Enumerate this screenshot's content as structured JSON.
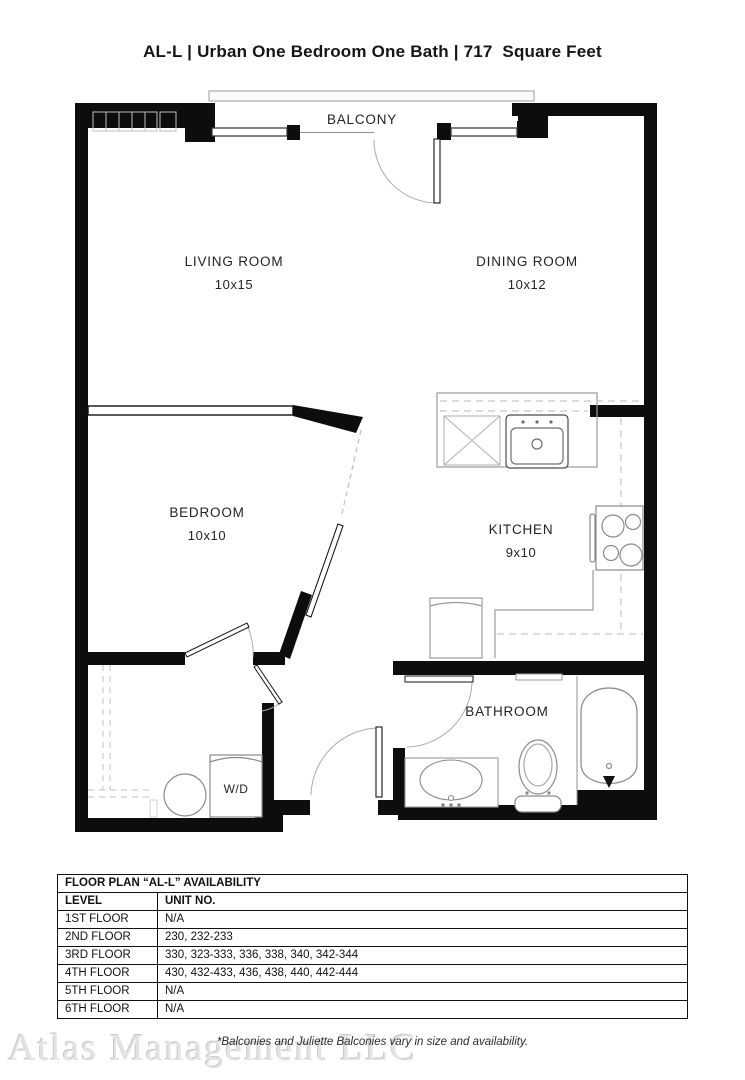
{
  "title": "AL-L | Urban One Bedroom One Bath | 717  Square Feet",
  "floor_plan": {
    "balcony_label": "BALCONY",
    "rooms": {
      "living": {
        "name": "LIVING ROOM",
        "dims": "10x15"
      },
      "dining": {
        "name": "DINING ROOM",
        "dims": "10x12"
      },
      "bedroom": {
        "name": "BEDROOM",
        "dims": "10x10"
      },
      "kitchen": {
        "name": "KITCHEN",
        "dims": "9x10"
      },
      "bathroom": {
        "name": "BATHROOM"
      },
      "laundry": {
        "name": "W/D"
      }
    },
    "colors": {
      "wall": "#0d0d0d",
      "fixture": "#8a8a8a",
      "counter_dash": "#c6c6c6",
      "door_arc": "#ababab"
    }
  },
  "availability_table": {
    "title": "FLOOR PLAN “AL-L” AVAILABILITY",
    "columns": [
      "LEVEL",
      "UNIT NO."
    ],
    "rows": [
      {
        "level": "1ST FLOOR",
        "units": "N/A"
      },
      {
        "level": "2ND FLOOR",
        "units": "230, 232-233"
      },
      {
        "level": "3RD FLOOR",
        "units": "330, 323-333, 336, 338, 340, 342-344"
      },
      {
        "level": "4TH FLOOR",
        "units": "430, 432-433, 436, 438, 440, 442-444"
      },
      {
        "level": "5TH FLOOR",
        "units": "N/A"
      },
      {
        "level": "6TH FLOOR",
        "units": "N/A"
      }
    ]
  },
  "footnote": "*Balconies and Juliette Balconies vary in size and availability.",
  "watermark": "Atlas Management LLC"
}
